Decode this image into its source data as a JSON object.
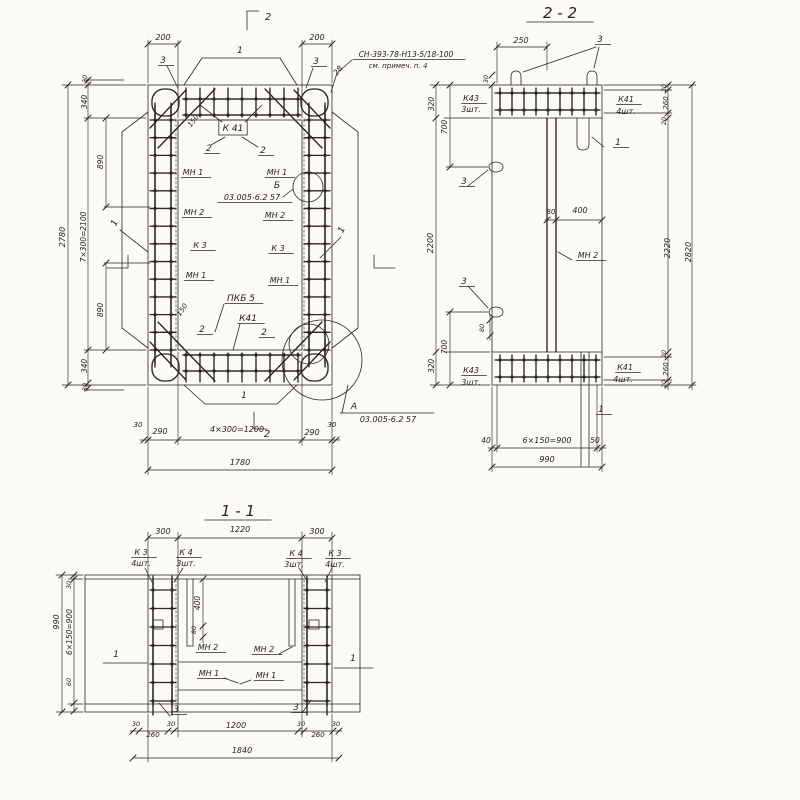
{
  "colors": {
    "paper": "#fbfaf5",
    "ink": "#2b2720"
  },
  "views": [
    {
      "id": "plan",
      "caption": ""
    },
    {
      "id": "section-2-2",
      "caption": "2 - 2"
    },
    {
      "id": "section-1-1",
      "caption": "1 - 1"
    }
  ],
  "labels": [
    {
      "n": "dim-200-left",
      "t": "200",
      "x": 163,
      "y": 40
    },
    {
      "n": "section-mark-2-top",
      "t": "2",
      "x": 268,
      "y": 20,
      "s": 10
    },
    {
      "n": "dim-200-right",
      "t": "200",
      "x": 317,
      "y": 40
    },
    {
      "n": "leader-3-top-left",
      "t": "3",
      "x": 163,
      "y": 63,
      "s": 9,
      "u": 1
    },
    {
      "n": "leader-3-top-right",
      "t": "3",
      "x": 316,
      "y": 64,
      "s": 9,
      "u": 1
    },
    {
      "n": "dim-28",
      "t": "28",
      "x": 340,
      "y": 72,
      "r": -52,
      "s": 7.5
    },
    {
      "n": "note-ref",
      "t": "СН-393-78-Н13-5/18-100",
      "x": 406,
      "y": 57,
      "s": 7.5,
      "u": 1
    },
    {
      "n": "note-see",
      "t": "см. примеч. п. 4",
      "x": 398,
      "y": 68,
      "s": 7
    },
    {
      "n": "bar-label-1-top",
      "t": "1",
      "x": 240,
      "y": 53,
      "s": 9
    },
    {
      "n": "dim-30-top-left",
      "t": "30",
      "x": 87,
      "y": 79,
      "r": -90,
      "s": 6.5
    },
    {
      "n": "dim-340-top",
      "t": "340",
      "x": 87,
      "y": 102,
      "r": -90,
      "s": 7.5
    },
    {
      "n": "dim-890-top",
      "t": "890",
      "x": 103,
      "y": 162,
      "r": -90,
      "s": 7.5
    },
    {
      "n": "dim-2780",
      "t": "2780",
      "x": 65,
      "y": 237,
      "r": -90,
      "s": 8
    },
    {
      "n": "dim-7x300",
      "t": "7×300=2100",
      "x": 86,
      "y": 237,
      "r": -90,
      "s": 7.5
    },
    {
      "n": "dim-890-bottom",
      "t": "890",
      "x": 103,
      "y": 310,
      "r": -90,
      "s": 7.5
    },
    {
      "n": "dim-340-bottom",
      "t": "340",
      "x": 87,
      "y": 366,
      "r": -90,
      "s": 7.5
    },
    {
      "n": "dim-30-bottom-left",
      "t": "30",
      "x": 87,
      "y": 387,
      "r": -90,
      "s": 6.5
    },
    {
      "n": "pos-label-K41-top",
      "t": "К 41",
      "x": 233,
      "y": 131,
      "s": 9,
      "box": 1
    },
    {
      "n": "dim-150-top",
      "t": "150",
      "x": 195,
      "y": 122,
      "r": -55,
      "s": 7
    },
    {
      "n": "pos-label-2-a",
      "t": "2",
      "x": 209,
      "y": 151,
      "s": 9,
      "u": 1
    },
    {
      "n": "pos-label-2-b",
      "t": "2",
      "x": 263,
      "y": 153,
      "s": 9,
      "u": 1
    },
    {
      "n": "pos-label-MN1-a",
      "t": "МН 1",
      "x": 193,
      "y": 175,
      "u": 1
    },
    {
      "n": "pos-label-MN1-b",
      "t": "МН 1",
      "x": 277,
      "y": 175,
      "u": 1
    },
    {
      "n": "detail-label-B",
      "t": "Б",
      "x": 277,
      "y": 188,
      "s": 9
    },
    {
      "n": "detail-ref-B",
      "t": "03.005-6.2 57",
      "x": 252,
      "y": 200,
      "s": 8,
      "u": 1
    },
    {
      "n": "pos-label-MN2-a",
      "t": "МН 2",
      "x": 194,
      "y": 215,
      "u": 1
    },
    {
      "n": "pos-label-MN2-b",
      "t": "МН 2",
      "x": 275,
      "y": 218,
      "u": 1
    },
    {
      "n": "pos-label-K3-a",
      "t": "К 3",
      "x": 200,
      "y": 248,
      "u": 1
    },
    {
      "n": "pos-label-K3-b",
      "t": "К 3",
      "x": 278,
      "y": 251,
      "u": 1
    },
    {
      "n": "pos-label-MN1-c",
      "t": "МН 1",
      "x": 196,
      "y": 278,
      "u": 1
    },
    {
      "n": "pos-label-MN1-d",
      "t": "МН 1",
      "x": 280,
      "y": 283,
      "u": 1
    },
    {
      "n": "pos-label-PKB5",
      "t": "ПКБ 5",
      "x": 241,
      "y": 301,
      "s": 9,
      "u": 1
    },
    {
      "n": "dim-150-bottom",
      "t": "150",
      "x": 184,
      "y": 311,
      "r": -55,
      "s": 7
    },
    {
      "n": "pos-label-K41-bottom",
      "t": "К41",
      "x": 248,
      "y": 321,
      "s": 9,
      "u": 1
    },
    {
      "n": "pos-label-2-c",
      "t": "2",
      "x": 202,
      "y": 332,
      "s": 9,
      "u": 1
    },
    {
      "n": "pos-label-2-d",
      "t": "2",
      "x": 264,
      "y": 335,
      "s": 9,
      "u": 1
    },
    {
      "n": "bar-label-1-left",
      "t": "1",
      "x": 117,
      "y": 224,
      "r": -65,
      "s": 9
    },
    {
      "n": "bar-label-1-right",
      "t": "1",
      "x": 344,
      "y": 231,
      "r": -65,
      "s": 9
    },
    {
      "n": "bar-label-1-bottom",
      "t": "1",
      "x": 244,
      "y": 398,
      "s": 9
    },
    {
      "n": "section-mark-2-bottom",
      "t": "2",
      "x": 267,
      "y": 437,
      "s": 10
    },
    {
      "n": "detail-label-A",
      "t": "А",
      "x": 354,
      "y": 409,
      "s": 9
    },
    {
      "n": "detail-ref-A",
      "t": "03.005-6.2 57",
      "x": 388,
      "y": 422,
      "s": 8
    },
    {
      "n": "dim-30-bl",
      "t": "30",
      "x": 138,
      "y": 427,
      "s": 7
    },
    {
      "n": "dim-290-left",
      "t": "290",
      "x": 160,
      "y": 434
    },
    {
      "n": "dim-4x300",
      "t": "4×300=1200",
      "x": 237,
      "y": 432
    },
    {
      "n": "dim-290-right",
      "t": "290",
      "x": 312,
      "y": 435
    },
    {
      "n": "dim-30-br",
      "t": "30",
      "x": 332,
      "y": 427,
      "s": 7
    },
    {
      "n": "dim-1780",
      "t": "1780",
      "x": 240,
      "y": 465
    },
    {
      "n": "title-section-2-2",
      "t": "2 - 2",
      "x": 560,
      "y": 18,
      "s": 15,
      "u": 1
    },
    {
      "n": "dim-250",
      "t": "250",
      "x": 521,
      "y": 43
    },
    {
      "n": "leader-3-s22-top",
      "t": "3",
      "x": 600,
      "y": 42,
      "s": 9,
      "u": 1
    },
    {
      "n": "dim-30-s22-top",
      "t": "30",
      "x": 488,
      "y": 79,
      "r": -90,
      "s": 6.5
    },
    {
      "n": "pos-K43-top",
      "t": "К43",
      "x": 471,
      "y": 101,
      "u": 1
    },
    {
      "n": "pos-K43-top-qty",
      "t": "3шт.",
      "x": 471,
      "y": 112
    },
    {
      "n": "pos-K41-s22-top",
      "t": "К41",
      "x": 626,
      "y": 102,
      "u": 1
    },
    {
      "n": "pos-K41-s22-top-qty",
      "t": "4шт.",
      "x": 626,
      "y": 114
    },
    {
      "n": "dim-320-top",
      "t": "320",
      "x": 434,
      "y": 104,
      "r": -90,
      "s": 7.5
    },
    {
      "n": "dim-700-top",
      "t": "700",
      "x": 447,
      "y": 127,
      "r": -90,
      "s": 7.5
    },
    {
      "n": "leader-3-s22-left-a",
      "t": "3",
      "x": 464,
      "y": 184,
      "s": 9,
      "u": 1
    },
    {
      "n": "dim-2200",
      "t": "2200",
      "x": 433,
      "y": 243,
      "r": -90,
      "s": 8
    },
    {
      "n": "leader-3-s22-left-b",
      "t": "3",
      "x": 464,
      "y": 284,
      "s": 9,
      "u": 1
    },
    {
      "n": "dim-80-s22-left",
      "t": "80",
      "x": 484,
      "y": 328,
      "r": -90,
      "s": 6.5
    },
    {
      "n": "dim-700-bottom",
      "t": "700",
      "x": 447,
      "y": 347,
      "r": -90,
      "s": 7.5
    },
    {
      "n": "dim-320-bottom",
      "t": "320",
      "x": 434,
      "y": 366,
      "r": -90,
      "s": 7.5
    },
    {
      "n": "pos-K43-bottom",
      "t": "К43",
      "x": 471,
      "y": 373,
      "u": 1
    },
    {
      "n": "pos-K43-bottom-qty",
      "t": "3шт.",
      "x": 471,
      "y": 385
    },
    {
      "n": "pos-K41-s22-bottom",
      "t": "К41",
      "x": 625,
      "y": 370,
      "u": 1
    },
    {
      "n": "pos-K41-s22-bottom-qty",
      "t": "4шт.",
      "x": 623,
      "y": 382
    },
    {
      "n": "dim-80-web",
      "t": "80",
      "x": 551,
      "y": 214,
      "s": 7
    },
    {
      "n": "dim-400-web",
      "t": "400",
      "x": 580,
      "y": 213
    },
    {
      "n": "pos-MN2-s22",
      "t": "МН 2",
      "x": 588,
      "y": 258,
      "u": 1
    },
    {
      "n": "bar-label-1-s22-top",
      "t": "1",
      "x": 618,
      "y": 145,
      "s": 9,
      "u": 1
    },
    {
      "n": "bar-label-1-s22-bottom",
      "t": "1",
      "x": 601,
      "y": 412,
      "s": 9,
      "u": 1
    },
    {
      "n": "dim-20-tr-a",
      "t": "20",
      "x": 666,
      "y": 88,
      "r": -90,
      "s": 6.5
    },
    {
      "n": "dim-260-tr",
      "t": "260",
      "x": 668,
      "y": 103,
      "r": -90,
      "s": 7
    },
    {
      "n": "dim-20-tr-b",
      "t": "20",
      "x": 666,
      "y": 121,
      "r": -90,
      "s": 6.5
    },
    {
      "n": "dim-2220",
      "t": "2220",
      "x": 670,
      "y": 248,
      "r": -90,
      "s": 8
    },
    {
      "n": "dim-2820",
      "t": "2820",
      "x": 691,
      "y": 252,
      "r": -90,
      "s": 8
    },
    {
      "n": "dim-20-br-a",
      "t": "20",
      "x": 666,
      "y": 354,
      "r": -90,
      "s": 6.5
    },
    {
      "n": "dim-260-br",
      "t": "260",
      "x": 668,
      "y": 369,
      "r": -90,
      "s": 7
    },
    {
      "n": "dim-20-br-b",
      "t": "20",
      "x": 666,
      "y": 384,
      "r": -90,
      "s": 6.5
    },
    {
      "n": "dim-40-s22",
      "t": "40",
      "x": 486,
      "y": 443,
      "s": 7.5
    },
    {
      "n": "dim-6x150-s22",
      "t": "6×150=900",
      "x": 547,
      "y": 443
    },
    {
      "n": "dim-50-s22",
      "t": "50",
      "x": 595,
      "y": 443,
      "s": 7.5
    },
    {
      "n": "dim-990",
      "t": "990",
      "x": 547,
      "y": 462
    },
    {
      "n": "title-section-1-1",
      "t": "1 - 1",
      "x": 238,
      "y": 516,
      "s": 15,
      "u": 1
    },
    {
      "n": "dim-300-left",
      "t": "300",
      "x": 163,
      "y": 534
    },
    {
      "n": "dim-1220",
      "t": "1220",
      "x": 240,
      "y": 532
    },
    {
      "n": "dim-300-right",
      "t": "300",
      "x": 317,
      "y": 534
    },
    {
      "n": "pos-K3-left",
      "t": "К 3",
      "x": 141,
      "y": 555,
      "u": 1
    },
    {
      "n": "pos-K3-left-qty",
      "t": "4шт.",
      "x": 141,
      "y": 566
    },
    {
      "n": "pos-K4-left",
      "t": "К 4",
      "x": 186,
      "y": 555,
      "u": 1
    },
    {
      "n": "pos-K4-left-qty",
      "t": "3шт.",
      "x": 186,
      "y": 566
    },
    {
      "n": "pos-K4-right",
      "t": "К 4",
      "x": 296,
      "y": 556,
      "u": 1
    },
    {
      "n": "pos-K4-right-qty",
      "t": "3шт.",
      "x": 294,
      "y": 567
    },
    {
      "n": "pos-K3-right",
      "t": "К 3",
      "x": 335,
      "y": 556,
      "u": 1
    },
    {
      "n": "pos-K3-right-qty",
      "t": "4шт.",
      "x": 335,
      "y": 567
    },
    {
      "n": "dim-30-s11",
      "t": "30",
      "x": 71,
      "y": 585,
      "r": -90,
      "s": 6.5
    },
    {
      "n": "dim-990-s11",
      "t": "990",
      "x": 59,
      "y": 622,
      "r": -90,
      "s": 8
    },
    {
      "n": "dim-6x150-s11",
      "t": "6×150=900",
      "x": 72,
      "y": 632,
      "r": -90,
      "s": 7.5
    },
    {
      "n": "dim-60-s11",
      "t": "60",
      "x": 71,
      "y": 682,
      "r": -90,
      "s": 6.5
    },
    {
      "n": "dim-400-s11",
      "t": "400",
      "x": 200,
      "y": 603,
      "r": -90,
      "s": 7.5
    },
    {
      "n": "dim-80-s11",
      "t": "80",
      "x": 196,
      "y": 630,
      "r": -90,
      "s": 6.5
    },
    {
      "n": "pos-MN2-s11-a",
      "t": "МН 2",
      "x": 208,
      "y": 650,
      "u": 1
    },
    {
      "n": "pos-MN2-s11-b",
      "t": "МН 2",
      "x": 264,
      "y": 652,
      "u": 1
    },
    {
      "n": "pos-MN1-s11-a",
      "t": "МН 1",
      "x": 209,
      "y": 676,
      "u": 1
    },
    {
      "n": "pos-MN1-s11-b",
      "t": "МН 1",
      "x": 266,
      "y": 678,
      "u": 1
    },
    {
      "n": "bar-label-1-s11-left",
      "t": "1",
      "x": 116,
      "y": 657,
      "s": 9
    },
    {
      "n": "bar-label-1-s11-right",
      "t": "1",
      "x": 353,
      "y": 661,
      "s": 9
    },
    {
      "n": "leader-3-s11-left",
      "t": "3",
      "x": 176,
      "y": 712,
      "s": 9,
      "u": 1
    },
    {
      "n": "leader-3-s11-right",
      "t": "3",
      "x": 296,
      "y": 710,
      "s": 9,
      "u": 1
    },
    {
      "n": "dim-30-s11-a",
      "t": "30",
      "x": 136,
      "y": 726,
      "s": 6.5
    },
    {
      "n": "dim-260-s11-a",
      "t": "260",
      "x": 153,
      "y": 737,
      "s": 7
    },
    {
      "n": "dim-30-s11-b",
      "t": "30",
      "x": 171,
      "y": 726,
      "s": 6.5
    },
    {
      "n": "dim-1200",
      "t": "1200",
      "x": 236,
      "y": 728
    },
    {
      "n": "dim-30-s11-c",
      "t": "30",
      "x": 301,
      "y": 726,
      "s": 6.5
    },
    {
      "n": "dim-260-s11-b",
      "t": "260",
      "x": 318,
      "y": 737,
      "s": 7
    },
    {
      "n": "dim-30-s11-d",
      "t": "30",
      "x": 336,
      "y": 726,
      "s": 6.5
    },
    {
      "n": "dim-1840",
      "t": "1840",
      "x": 242,
      "y": 753
    }
  ]
}
